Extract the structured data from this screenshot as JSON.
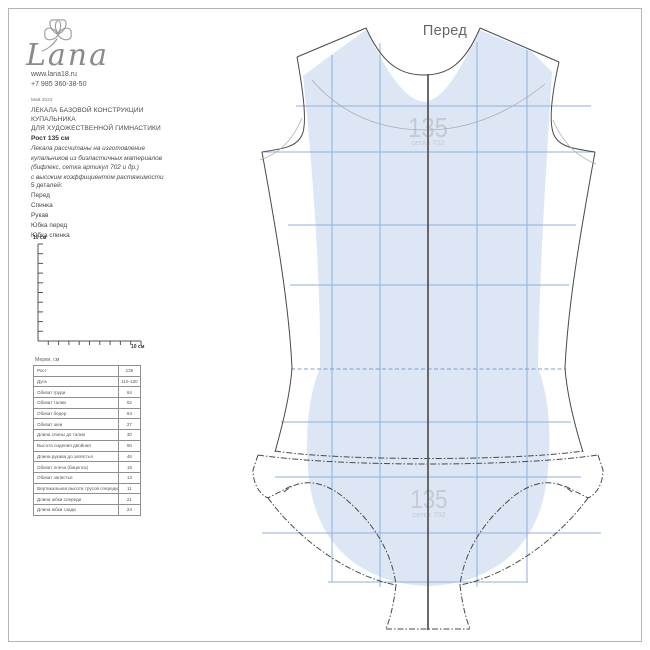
{
  "colors": {
    "pattern_fill": "#dce6f5",
    "grid_blue": "#8fafdd",
    "outline_dark": "#4a4a4a",
    "center_line": "#5a5a5a",
    "watermark_gray": "#c6cad1",
    "text_dark": "#444444"
  },
  "brand": {
    "name": "Lana",
    "website": "www.lana18.ru",
    "phone": "+7 985 360-38-50"
  },
  "doc": {
    "date": "Май 2023",
    "title_line1": "ЛЕКАЛА БАЗОВОЙ КОНСТРУКЦИИ",
    "title_line2": "КУПАЛЬНИКА",
    "title_line3": "ДЛЯ ХУДОЖЕСТВЕННОЙ ГИМНАСТИКИ",
    "height": "Рост 135 см",
    "desc_line1": "Лекала рассчитаны на изготовление",
    "desc_line2": "купальников из биэластичных материалов",
    "desc_line3": "(бифлекс, сетка артикул 702 и др.)",
    "desc_line4": "с высоким коэффициентом растяжимости",
    "details_header": "5 деталей:",
    "details": [
      "Перед",
      "Спинка",
      "Рукав",
      "Юбка перед",
      "Юбка спинка"
    ]
  },
  "ruler": {
    "vertical_label": "10 см",
    "horizontal_label": "10 см"
  },
  "measurements": {
    "caption": "Мерки, см",
    "rows": [
      [
        "Рост",
        "135"
      ],
      [
        "Дуга",
        "110-120"
      ],
      [
        "Обхват груди",
        "64"
      ],
      [
        "Обхват талии",
        "52"
      ],
      [
        "Обхват бедер",
        "64"
      ],
      [
        "Обхват шеи",
        "27"
      ],
      [
        "Длина спины до талии",
        "30"
      ],
      [
        "Высота сидения двойная",
        "50"
      ],
      [
        "Длина рукава до запястья",
        "46"
      ],
      [
        "Обхват плеча (бицепса)",
        "19"
      ],
      [
        "Обхват запястья",
        "13"
      ],
      [
        "Вертикальная высота трусов спереди",
        "11"
      ],
      [
        "Длина юбки спереди",
        "21"
      ],
      [
        "Длина юбки сзади",
        "24"
      ]
    ]
  },
  "pattern": {
    "piece_title": "Перед",
    "size_watermark": "135",
    "mesh_watermark": "сетка 702"
  }
}
